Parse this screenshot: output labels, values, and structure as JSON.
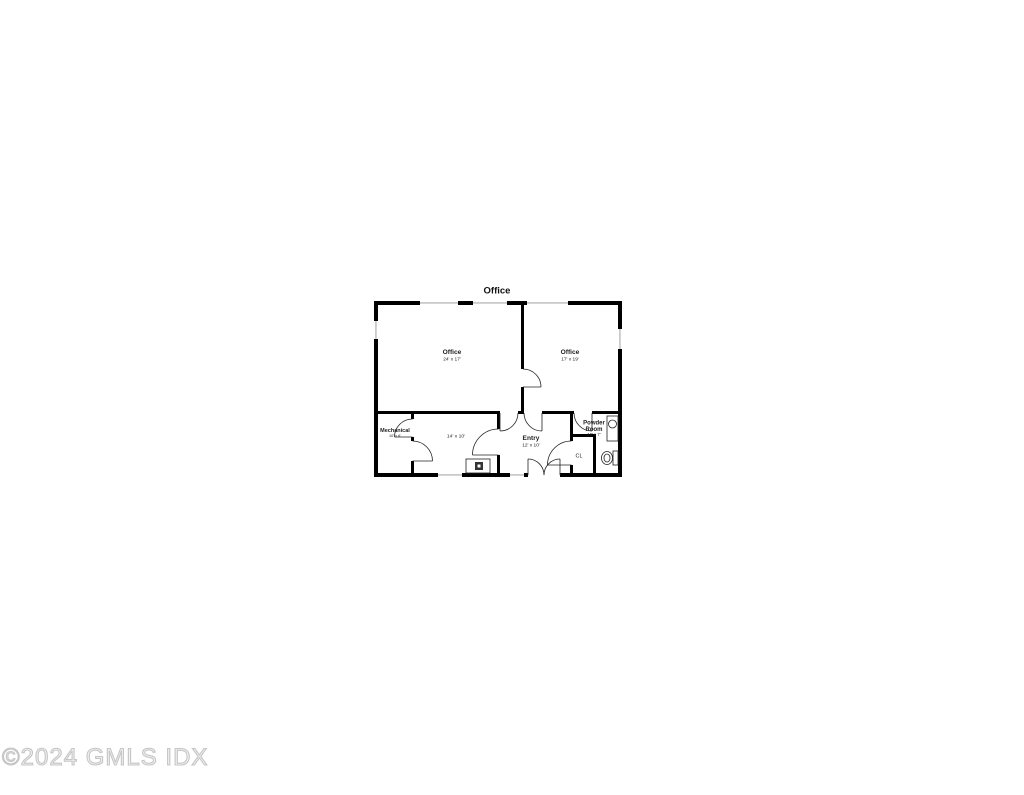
{
  "floor_plan": {
    "title": "Office",
    "rooms": {
      "office_main": {
        "name": "Office",
        "dims": "24' x 17'"
      },
      "office_second": {
        "name": "Office",
        "dims": "17' x 19'"
      },
      "room_14x10": {
        "dims": "14' x 10'"
      },
      "mechanical": {
        "name": "Mechanical",
        "dims": "10' x 6'"
      },
      "entry": {
        "name": "Entry",
        "dims": "12' x 10'"
      },
      "powder_room": {
        "name_line1": "Powder",
        "name_line2": "Room",
        "dims": "10' x 7'"
      },
      "closet": {
        "name": "CL"
      }
    },
    "fixtures": [
      "toilet-icon",
      "sink-icon",
      "stove-icon"
    ],
    "colors": {
      "wall": "#000000",
      "window_line": "#a8a8a8",
      "door_arc": "#222222",
      "watermark": "#c6c6c6",
      "background": "#ffffff"
    }
  },
  "watermark": {
    "text": "©2024 GMLS IDX"
  }
}
